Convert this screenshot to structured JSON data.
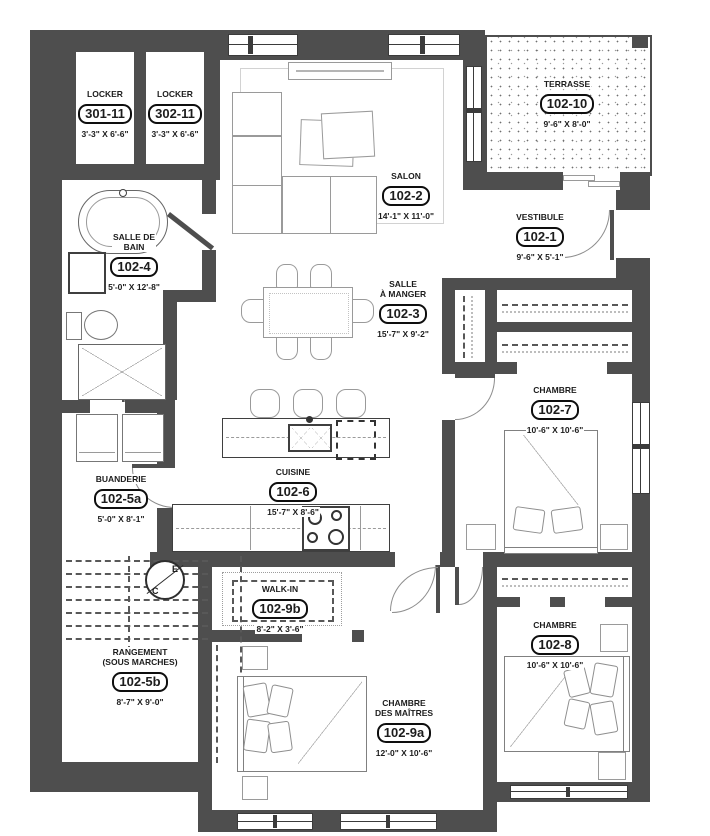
{
  "floor_plan": {
    "rooms": [
      {
        "name": "LOCKER",
        "number": "301-11",
        "dims": "3'-3\" X 6'-6\""
      },
      {
        "name": "LOCKER",
        "number": "302-11",
        "dims": "3'-3\" X 6'-6\""
      },
      {
        "name": "SALON",
        "number": "102-2",
        "dims": "14'-1\" X 11'-0\""
      },
      {
        "name": "TERRASSE",
        "number": "102-10",
        "dims": "9'-6\" X 8'-0\""
      },
      {
        "name": "VESTIBULE",
        "number": "102-1",
        "dims": "9'-6\" X 5'-1\""
      },
      {
        "name": "SALLE DE\nBAIN",
        "number": "102-4",
        "dims": "5'-0\" X 12'-8\""
      },
      {
        "name": "SALLE\nÀ MANGER",
        "number": "102-3",
        "dims": "15'-7\" X 9'-2\""
      },
      {
        "name": "CHAMBRE",
        "number": "102-7",
        "dims": "10'-6\" X 10'-6\""
      },
      {
        "name": "BUANDERIE",
        "number": "102-5a",
        "dims": "5'-0\" X 8'-1\""
      },
      {
        "name": "CUISINE",
        "number": "102-6",
        "dims": "15'-7\" X 8'-6\""
      },
      {
        "name": "WALK-IN",
        "number": "102-9b",
        "dims": "8'-2\" X 3'-6\""
      },
      {
        "name": "RANGEMENT\n(SOUS MARCHES)",
        "number": "102-5b",
        "dims": "8'-7\" X 9'-0\""
      },
      {
        "name": "CHAMBRE\nDES MAÎTRES",
        "number": "102-9a",
        "dims": "12'-0\" X 10'-6\""
      },
      {
        "name": "CHAMBRE",
        "number": "102-8",
        "dims": "10'-6\" X 10'-6\""
      }
    ],
    "symbols": {
      "electrical_panel": {
        "top": "E",
        "bottom": "C"
      }
    },
    "colors": {
      "wall": "#4e4e4e",
      "line": "#9a9a9a",
      "ink": "#1c1c1c"
    }
  }
}
